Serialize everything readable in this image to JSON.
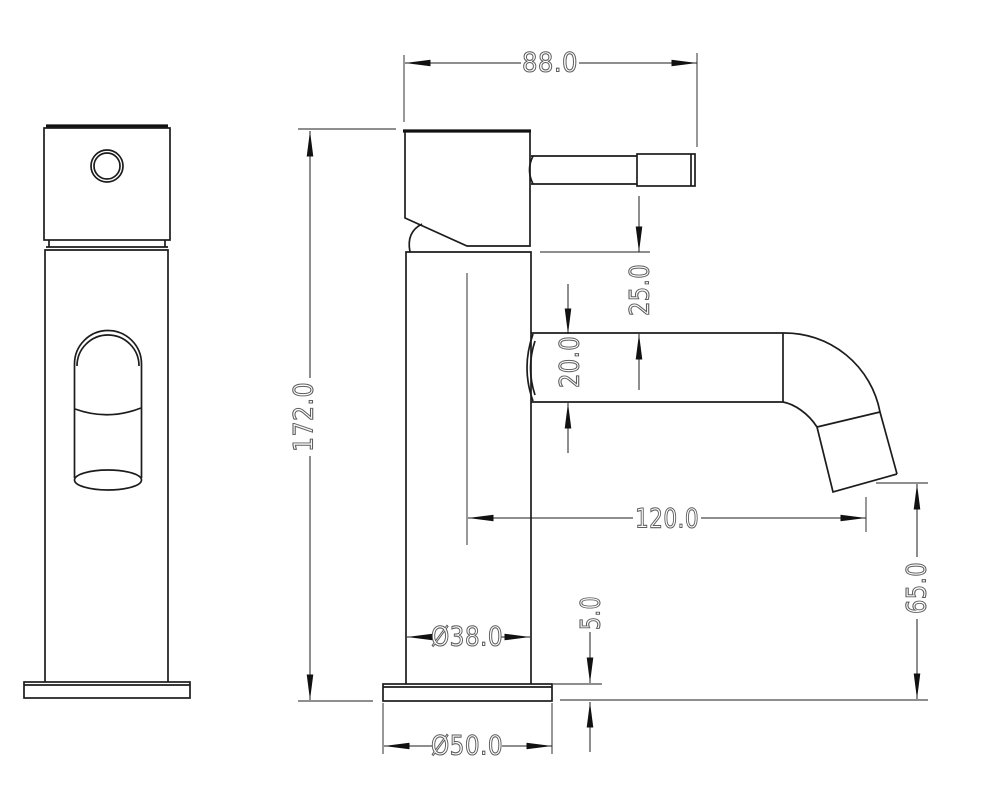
{
  "drawing": {
    "kind": "technical-dimension-drawing",
    "views": [
      "front-view",
      "side-view"
    ]
  },
  "dimensions": {
    "head_width": "88.0",
    "overall_height": "172.0",
    "body_top_to_spout": "25.0",
    "spout_tube_diameter": "20.0",
    "spout_reach": "120.0",
    "spout_outlet_height": "65.0",
    "base_plate_thickness": "5.0",
    "body_diameter": "Ø38.0",
    "base_diameter": "Ø50.0"
  },
  "colors": {
    "object_line": "#1c1c1c",
    "dimension_line": "#1c1c1c",
    "text_outline": "#5e5e5e",
    "background": "#ffffff"
  }
}
